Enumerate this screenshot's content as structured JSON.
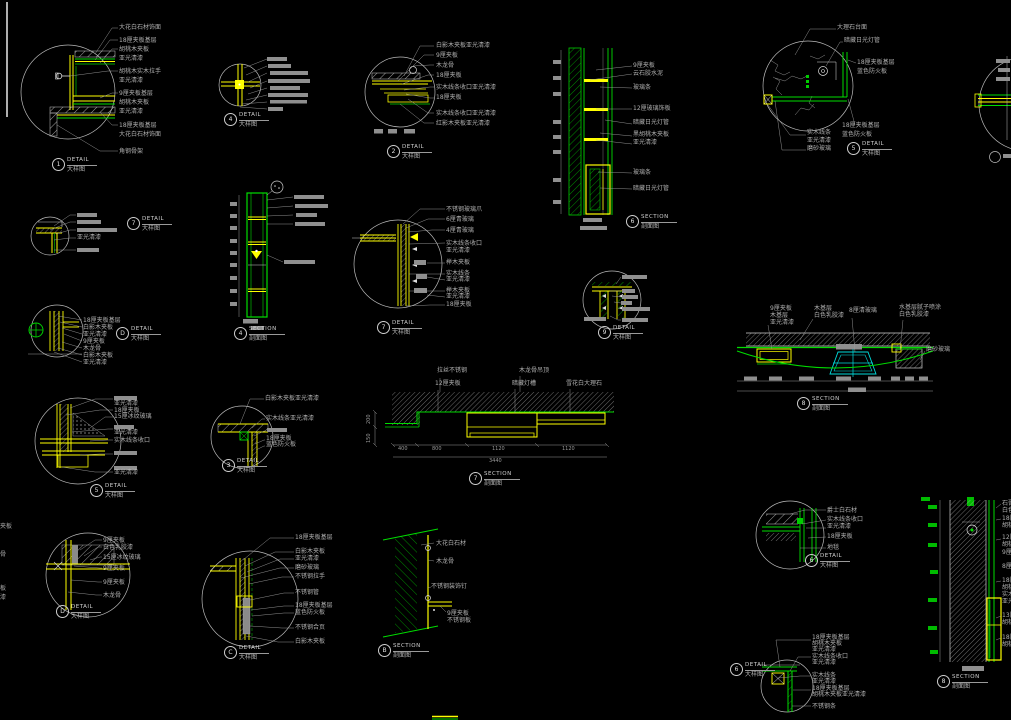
{
  "sheet": {
    "type": "CAD construction detail sheet",
    "palette": {
      "background": "#000000",
      "line_green": "#00dd00",
      "line_yellow": "#ffff00",
      "line_cyan": "#00dddd",
      "line_white": "#d0d0d0",
      "annotation_gray": "#b0b0b0"
    }
  },
  "details": {
    "d1": {
      "bubble": "1",
      "title": "DETAIL",
      "subtitle": "大样图",
      "labels": [
        "大花白石材饰面",
        "18厘夹板基层",
        "胡桃木夹板",
        "亚光清漆",
        "胡桃木实木拉手",
        "亚光清漆",
        "9厘夹板基层",
        "胡桃木夹板",
        "亚光清漆",
        "18厘夹板基层",
        "大花白石材饰面",
        "角钢骨架"
      ]
    },
    "d4": {
      "bubble": "4",
      "title": "DETAIL",
      "subtitle": "大样图",
      "labels": []
    },
    "d2": {
      "bubble": "2",
      "title": "DETAIL",
      "subtitle": "大样图",
      "labels": [
        "白影木夹板亚光清漆",
        "9厘夹板",
        "木龙骨",
        "18厘夹板",
        "实木线条收口亚光清漆",
        "18厘夹板",
        "实木线条收口亚光清漆",
        "红影木夹板亚光清漆"
      ]
    },
    "s6": {
      "bubble": "6",
      "title": "SECTION",
      "subtitle": "剖面图",
      "labels": [
        "9厘夹板",
        "云石胶水泥",
        "玻璃条",
        "12厘玻璃饰板",
        "暗藏日光灯管",
        "黑胡桃木夹板",
        "亚光清漆",
        "玻璃条",
        "暗藏日光灯管"
      ]
    },
    "d5t": {
      "bubble": "5",
      "title": "DETAIL",
      "subtitle": "大样图",
      "labels": [
        "大理石台面",
        "暗藏日光灯管",
        "18厘夹板基层",
        "蓝色防火板",
        "18厘夹板基层",
        "蓝色防火板",
        "实木线条",
        "亚光清漆",
        "磨砂玻璃"
      ]
    },
    "db": {
      "bubble": "7",
      "title": "DETAIL",
      "subtitle": "大样图",
      "labels": [
        "亚光清漆"
      ]
    },
    "dd2": {
      "bubble": "D",
      "title": "DETAIL",
      "subtitle": "大样图",
      "labels": [
        "18厘夹板基层",
        "白影木夹板",
        "亚光清漆",
        "9厘夹板",
        "木龙骨",
        "白影木夹板",
        "亚光清漆"
      ]
    },
    "s4": {
      "bubble": "4",
      "title": "SECTION",
      "subtitle": "剖面图",
      "labels": []
    },
    "d7": {
      "bubble": "7",
      "title": "DETAIL",
      "subtitle": "大样图",
      "labels": [
        "不锈钢玻璃爪",
        "6厘青玻璃",
        "4厘青玻璃",
        "实木线条收口",
        "亚光清漆",
        "榉木夹板",
        "实木线条",
        "亚光清漆",
        "榉木夹板",
        "亚光清漆",
        "18厘夹板"
      ]
    },
    "dm": {
      "bubble": "9",
      "title": "DETAIL",
      "subtitle": "大样图",
      "labels": []
    },
    "s8c": {
      "bubble": "8",
      "title": "SECTION",
      "subtitle": "剖面图",
      "labels": [
        "9厘夹板",
        "木基层",
        "亚光清漆",
        "木基层",
        "白色乳胶漆",
        "8厘清玻璃",
        "水基层腻子喷涂",
        "白色乳胶漆",
        "磨砂玻璃"
      ]
    },
    "s7": {
      "bubble": "7",
      "title": "SECTION",
      "subtitle": "剖面图",
      "labels": [
        "拉丝不锈钢",
        "12厘夹板",
        "木龙骨吊顶",
        "暗藏灯槽",
        "雪花白大理石"
      ],
      "dims": [
        "400",
        "800",
        "1120",
        "1120",
        "3440",
        "200",
        "150"
      ]
    },
    "d5b": {
      "bubble": "5",
      "title": "DETAIL",
      "subtitle": "大样图",
      "labels": [
        "亚光清漆",
        "18厘夹板",
        "15厘冰纹玻璃",
        "亚光清漆",
        "实木线条收口",
        "亚光清漆"
      ]
    },
    "d3": {
      "bubble": "3",
      "title": "DETAIL",
      "subtitle": "大样图",
      "labels": [
        "白影木夹板亚光清漆",
        "实木线条亚光清漆",
        "18厘夹板",
        "蓝色防火板"
      ]
    },
    "dD": {
      "bubble": "D",
      "title": "DETAIL",
      "subtitle": "大样图",
      "labels": [
        "9厘夹板",
        "白色乳胶漆",
        "15厘冰纹玻璃",
        "9厘夹板",
        "9厘夹板",
        "木龙骨"
      ]
    },
    "dC": {
      "bubble": "C",
      "title": "DETAIL",
      "subtitle": "大样图",
      "labels": [
        "18厘夹板基层",
        "白影木夹板",
        "亚光清漆",
        "磨砂玻璃",
        "不锈钢拉手",
        "不锈钢管",
        "18厘夹板基层",
        "蓝色防火板",
        "不锈钢合页",
        "白影木夹板"
      ]
    },
    "sB": {
      "bubble": "B",
      "title": "SECTION",
      "subtitle": "剖面图",
      "labels": [
        "大花白石材",
        "木龙骨",
        "不锈钢装饰钉",
        "9厘夹板",
        "不锈钢板"
      ]
    },
    "d6r": {
      "bubble": "6",
      "title": "DETAIL",
      "subtitle": "大样图",
      "labels": [
        "爵士白石材",
        "实木线条收口",
        "亚光清漆",
        "18厘夹板",
        "地毯"
      ]
    },
    "s8r": {
      "bubble": "8",
      "title": "SECTION",
      "subtitle": "剖面图",
      "labels": [
        "石膏顶",
        "白色乳",
        "18厘夹",
        "胡桃木",
        "12厘夹",
        "胡桃木",
        "9厘夹板",
        "8厘玻",
        "18厘夹",
        "胡桃木",
        "实木线",
        "亚光清",
        "13厘夹",
        "胡桃木",
        "18厘夹",
        "胡桃木"
      ]
    },
    "dbr": {
      "bubble": "6",
      "title": "DETAIL",
      "subtitle": "大样图",
      "labels": [
        "18厘夹板基层",
        "胡桃木夹板",
        "亚光清漆",
        "实木线条收口",
        "亚光清漆",
        "实木线条",
        "亚光清漆",
        "18厘夹板基层",
        "胡桃木夹板亚光清漆",
        "不锈钢条"
      ]
    }
  },
  "edge": {
    "fragments": [
      "夹板",
      "骨",
      "板",
      "漆"
    ]
  }
}
